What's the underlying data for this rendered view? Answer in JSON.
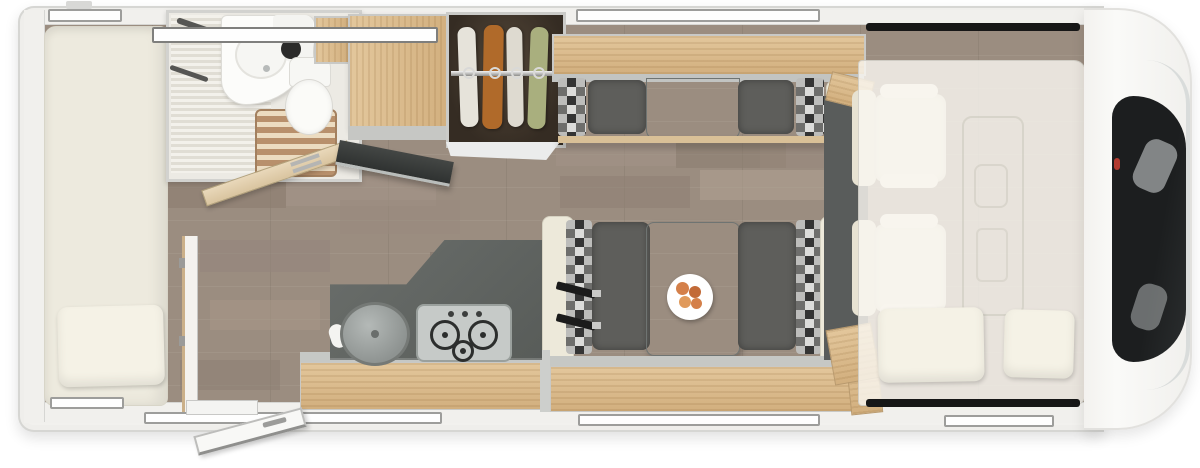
{
  "meta": {
    "title": "Motorhome interior floor plan, top-down 3D render",
    "view": "top-down",
    "visible_text": "none"
  },
  "palette": {
    "wall": "#f2f1ee",
    "wall_edge": "#d6d6d3",
    "floor_base": "#9b8d80",
    "wood": "#e3c79c",
    "wood_dark": "#d2af7e",
    "counter": "#636764",
    "cushion": "#5e5e5b",
    "table": "#868b88",
    "check_a": "#343434",
    "check_b": "#dcdcda",
    "check_c": "#6e6e6c",
    "check_d": "#bdbdbb",
    "cream": "#ede9da",
    "bed": "#edeade",
    "pillow": "#f5f2e6",
    "glass": "#1e2021",
    "belt": "#1b1b1b",
    "chrome": "#d9dcdb",
    "accent_red": "#b23b30",
    "garment1": "#e6e3da",
    "garment2": "#b06a2a",
    "garment3": "#dedad0",
    "garment4": "#a9af7e",
    "plate": "#ffffff",
    "food1": "#d4804a",
    "food2": "#c26a38",
    "food3": "#e09a5c"
  },
  "inventory": {
    "rear_bedroom": {
      "items": [
        "french-bed",
        "pillow"
      ]
    },
    "bathroom": {
      "items": [
        "vanity-sink",
        "round-basin",
        "faucet",
        "towel-rail",
        "teak-shower-floor",
        "toilet",
        "pleated-blind"
      ]
    },
    "kitchen": {
      "items": [
        "l-shaped-counter",
        "round-sink-with-lid",
        "hob-3-burner",
        "tall-cabinet",
        "open-worktop-flap",
        "overhead-lockers"
      ],
      "burners": 3
    },
    "wardrobe": {
      "garment_count": 4,
      "garment_colors": [
        "white",
        "rust-orange",
        "white",
        "green"
      ],
      "items": [
        "chrome-rail",
        "hangers"
      ]
    },
    "dinette": {
      "items": [
        "table",
        "plate-of-fruit",
        "bench-left",
        "bench-right",
        "checkered-bolsters",
        "seat-belts",
        "sofa-bench-top",
        "overhead-locker"
      ],
      "seat_belt_count": 2
    },
    "cab": {
      "items": [
        "swivel-seat-top",
        "swivel-seat-bottom",
        "drop-down-bed",
        "bed-pillow-left",
        "bed-pillow-right",
        "side-window-top",
        "side-window-bottom",
        "windshield",
        "dashboard-outline"
      ],
      "seats": 2,
      "pillows": 2
    },
    "openings": {
      "entry_door": "open",
      "bathroom_door": "open",
      "window_marker_count": 7
    }
  }
}
